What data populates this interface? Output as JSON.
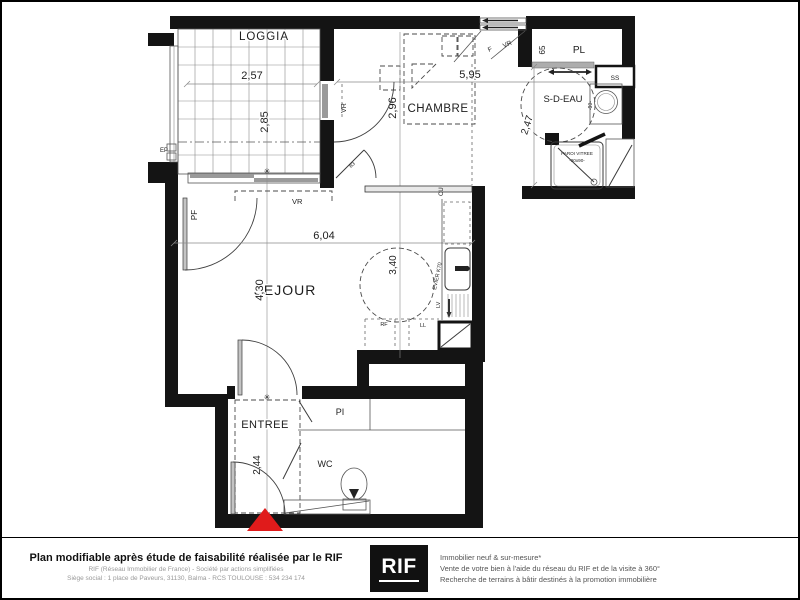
{
  "plan": {
    "rooms": {
      "loggia": {
        "name": "LOGGIA",
        "width": "2,57",
        "height": "2,85"
      },
      "chambre": {
        "name": "CHAMBRE",
        "width": "5,95",
        "height": "2,96"
      },
      "sdeau": {
        "name": "S-D-EAU",
        "height": "2,47"
      },
      "placard": {
        "name": "PL",
        "depth": "65"
      },
      "sejour": {
        "name": "SEJOUR",
        "width": "6,04",
        "height": "4,30",
        "turning_circle": "3,40"
      },
      "entree": {
        "name": "ENTREE",
        "height": "2,44"
      },
      "placard_entree": {
        "name": "PI"
      },
      "wc": {
        "name": "WC"
      }
    },
    "labels": {
      "vr_loggia": "VR",
      "vr_chambre_door": "VR",
      "vr_window": "VR",
      "f_window": "F",
      "pf": "PF",
      "ep": "EP",
      "ss": "SS",
      "cu": "CU",
      "evier": "EVIER K70",
      "lv": "LV",
      "rf": "RF",
      "ll": "LL",
      "b3": "B3",
      "paroi_line1": "PAROI VITREE",
      "paroi_line2": "-90x90-",
      "d90": "-90-",
      "star": "✳"
    },
    "colors": {
      "wall": "#141414",
      "entrance_marker": "#e01b1b"
    }
  },
  "footer": {
    "disclaimer_bold": "Plan modifiable après étude de faisabilité réalisée par le RIF",
    "disclaimer_line1": "RIF (Réseau Immobilier de France) - Société par actions simplifiées",
    "disclaimer_line2": "Siège social : 1 place de Paveurs, 31130, Balma - RCS TOULOUSE : 534 234 174",
    "logo_text": "RIF",
    "services": [
      "Immobilier neuf & sur-mesure*",
      "Vente de votre bien à l'aide du réseau du RIF et de la visite à 360°",
      "Recherche de terrains à bâtir destinés à la promotion immobilière"
    ]
  }
}
